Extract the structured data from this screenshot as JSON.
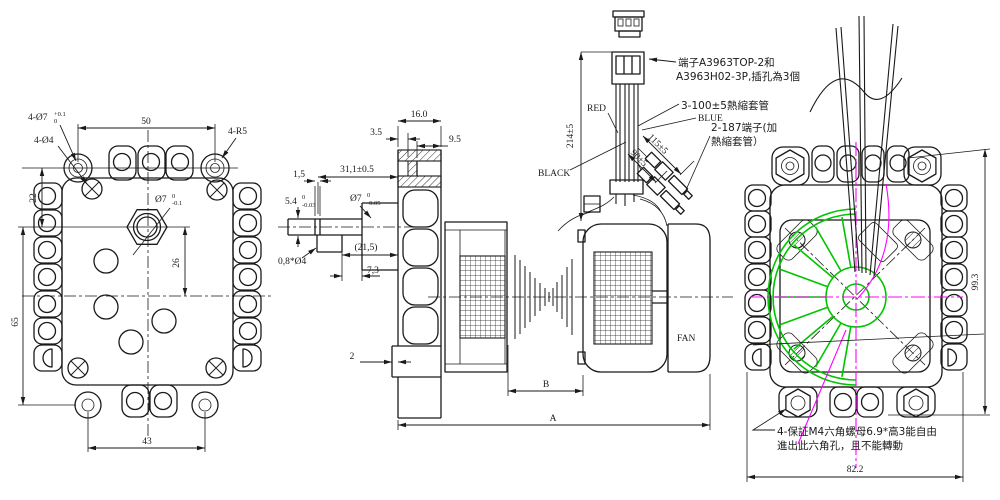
{
  "colors": {
    "ink": "#1a1a1a",
    "green": "#00c400",
    "magenta": "#ff00ff",
    "background": "#ffffff"
  },
  "front_view": {
    "dim_top_width": "50",
    "dim_bottom_width": "43",
    "dim_left_upper": "22",
    "dim_left_lower": "65",
    "dim_shaft_offset": "26",
    "label_corner_holes": "4-Ø7",
    "label_corner_holes_tol_upper": "+0.1",
    "label_corner_holes_tol_lower": "0",
    "label_screw_holes": "4-Ø4",
    "label_corner_radius": "4-R5",
    "label_shaft_hole": "Ø7",
    "label_shaft_hole_tol_upper": "0",
    "label_shaft_hole_tol_lower": "-0.1"
  },
  "side_view": {
    "dim_tube_length": "16.0",
    "dim_tube_step": "3.5",
    "dim_tube_bore": "9.5",
    "dim_shaft_length": "31,1±0.5",
    "dim_flat_length": "1,5",
    "dim_flat_height": "5.4",
    "dim_flat_height_tol_upper": "0",
    "dim_flat_height_tol_lower": "-0.03",
    "label_shaft_dia": "Ø7",
    "label_shaft_dia_tol_upper": "0",
    "label_shaft_dia_tol_lower": "-0.05",
    "label_chamfer": "0,8*Ø4",
    "dim_boss_length": "(21,5)",
    "dim_boss_step": "7,3",
    "dim_wall": "2",
    "dim_b": "B",
    "dim_a": "A",
    "dim_wire_length": "214±5",
    "label_fan": "FAN"
  },
  "wiring": {
    "label_red": "RED",
    "label_black": "BLACK",
    "label_blue": "BLUE",
    "note_connector_line1": "端子A3963TOP-2和",
    "note_connector_line2": "A3963H02-3P,插孔為3個",
    "note_sleeve": "3-100±5熱縮套管",
    "note_terminal_line1": "2-187端子(加",
    "note_terminal_line2": "熱縮套管）",
    "dim_terminal_long": "115±5",
    "dim_terminal_short": "90±5"
  },
  "rear_view": {
    "dim_height": "99.3",
    "dim_width": "82.2",
    "note_line1": "4-保証M4六角螺母6.9*高3能自由",
    "note_line2": "進出此六角孔，且不能轉動"
  }
}
